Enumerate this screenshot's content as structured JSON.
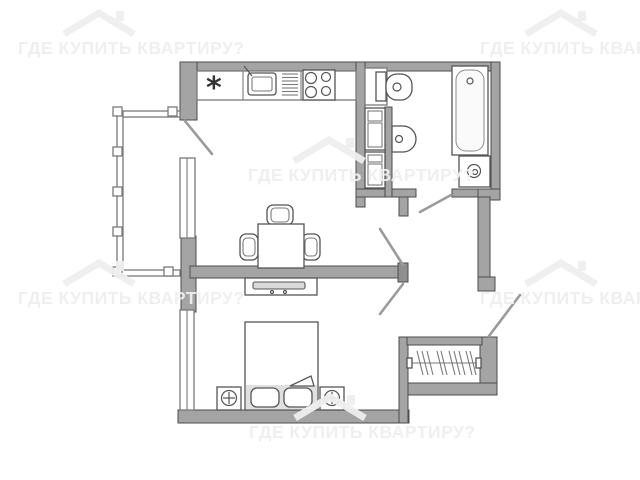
{
  "watermark": {
    "text": "ГДЕ КУПИТЬ КВАРТИРУ?",
    "color": "#eeeeee",
    "instances": [
      {
        "x": 18,
        "y": 39
      },
      {
        "x": 480,
        "y": 39
      },
      {
        "x": 248,
        "y": 166
      },
      {
        "x": 18,
        "y": 289
      },
      {
        "x": 480,
        "y": 289
      },
      {
        "x": 249,
        "y": 423
      }
    ]
  },
  "floorplan": {
    "canvas": {
      "w": 640,
      "h": 480
    },
    "palette": {
      "wall": "#a4a4a4",
      "wall_outline": "#4d4d4d",
      "fixture_line": "#7a7a7a",
      "shade": "#e0e0e0",
      "door_leaf": "#9b9b9b"
    },
    "kitchen_symbol": "*",
    "shapes": [
      {
        "name": "wall-top",
        "kind": "rect",
        "cls": "wall",
        "x": 183,
        "y": 62,
        "w": 317,
        "h": 9
      },
      {
        "name": "wall-left-upper",
        "kind": "rect",
        "cls": "wall",
        "x": 180,
        "y": 62,
        "w": 17,
        "h": 58
      },
      {
        "name": "wall-left-mid",
        "kind": "rect",
        "cls": "wall",
        "x": 181,
        "y": 236,
        "w": 15,
        "h": 76
      },
      {
        "name": "wall-bottom-bedroom",
        "kind": "rect",
        "cls": "wall",
        "x": 178,
        "y": 410,
        "w": 231,
        "h": 13
      },
      {
        "name": "wall-middle",
        "kind": "rect",
        "cls": "wall",
        "x": 190,
        "y": 266,
        "w": 210,
        "h": 12
      },
      {
        "name": "wall-middle-endcap",
        "kind": "rect",
        "cls": "walld",
        "x": 398,
        "y": 263,
        "w": 10,
        "h": 19
      },
      {
        "name": "wall-living-right",
        "kind": "rect",
        "cls": "wall",
        "x": 356,
        "y": 62,
        "w": 9,
        "h": 145
      },
      {
        "name": "wall-bath-bottom-left",
        "kind": "rect",
        "cls": "wall",
        "x": 356,
        "y": 189,
        "w": 60,
        "h": 8
      },
      {
        "name": "wall-door-stub",
        "kind": "rect",
        "cls": "wall",
        "x": 399,
        "y": 197,
        "w": 9,
        "h": 19
      },
      {
        "name": "wall-bath-bottom-right",
        "kind": "rect",
        "cls": "wall",
        "x": 452,
        "y": 189,
        "w": 48,
        "h": 8
      },
      {
        "name": "wall-right-top",
        "kind": "rect",
        "cls": "wall",
        "x": 491,
        "y": 62,
        "w": 9,
        "h": 135
      },
      {
        "name": "wall-right-corner",
        "kind": "rect",
        "cls": "wall",
        "x": 478,
        "y": 189,
        "w": 22,
        "h": 11
      },
      {
        "name": "wall-hall-right",
        "kind": "rect",
        "cls": "wall",
        "x": 478,
        "y": 197,
        "w": 12,
        "h": 80
      },
      {
        "name": "wall-entrance-jamb",
        "kind": "rect",
        "cls": "wall",
        "x": 478,
        "y": 277,
        "w": 17,
        "h": 14
      },
      {
        "name": "wall-wardrobe-right",
        "kind": "rect",
        "cls": "wall",
        "x": 480,
        "y": 337,
        "w": 17,
        "h": 58
      },
      {
        "name": "wall-wardrobe-bottom",
        "kind": "rect",
        "cls": "wall",
        "x": 399,
        "y": 383,
        "w": 98,
        "h": 12
      },
      {
        "name": "wall-bedroom-right",
        "kind": "rect",
        "cls": "wall",
        "x": 399,
        "y": 337,
        "w": 9,
        "h": 86
      },
      {
        "name": "wall-wardrobe-top",
        "kind": "rect",
        "cls": "wall",
        "x": 407,
        "y": 337,
        "w": 75,
        "h": 8
      },
      {
        "name": "wall-bath-inner-stub",
        "kind": "rect",
        "cls": "wall",
        "x": 385,
        "y": 107,
        "w": 7,
        "h": 90
      },
      {
        "name": "window-kitchen",
        "kind": "rect",
        "cls": "fix",
        "x": 180,
        "y": 158,
        "w": 15,
        "h": 80
      },
      {
        "name": "window-kitchen-mullion",
        "kind": "line",
        "cls": "thin",
        "x1": 187,
        "y1": 158,
        "x2": 187,
        "y2": 238
      },
      {
        "name": "window-bedroom",
        "kind": "rect",
        "cls": "fix",
        "x": 180,
        "y": 310,
        "w": 14,
        "h": 100
      },
      {
        "name": "window-bedroom-mullion",
        "kind": "line",
        "cls": "thin",
        "x1": 187,
        "y1": 310,
        "x2": 187,
        "y2": 410
      },
      {
        "name": "balcony-rail-top",
        "kind": "rect",
        "cls": "fix",
        "x": 117,
        "y": 111,
        "w": 63,
        "h": 6
      },
      {
        "name": "balcony-rail-left",
        "kind": "rect",
        "cls": "fix",
        "x": 117,
        "y": 111,
        "w": 6,
        "h": 165
      },
      {
        "name": "balcony-rail-bottom",
        "kind": "rect",
        "cls": "fix",
        "x": 117,
        "y": 270,
        "w": 63,
        "h": 6
      },
      {
        "name": "balcony-post",
        "kind": "rect",
        "cls": "fix",
        "x": 113,
        "y": 107,
        "w": 9,
        "h": 9
      },
      {
        "name": "balcony-post",
        "kind": "rect",
        "cls": "fix",
        "x": 113,
        "y": 147,
        "w": 9,
        "h": 9
      },
      {
        "name": "balcony-post",
        "kind": "rect",
        "cls": "fix",
        "x": 113,
        "y": 187,
        "w": 9,
        "h": 9
      },
      {
        "name": "balcony-post",
        "kind": "rect",
        "cls": "fix",
        "x": 113,
        "y": 227,
        "w": 9,
        "h": 9
      },
      {
        "name": "balcony-post",
        "kind": "rect",
        "cls": "fix",
        "x": 113,
        "y": 267,
        "w": 9,
        "h": 9
      },
      {
        "name": "balcony-post",
        "kind": "rect",
        "cls": "fix",
        "x": 168,
        "y": 107,
        "w": 9,
        "h": 9
      },
      {
        "name": "balcony-post",
        "kind": "rect",
        "cls": "fix",
        "x": 164,
        "y": 267,
        "w": 9,
        "h": 9
      },
      {
        "name": "kitchen-counter",
        "kind": "rect",
        "cls": "fix",
        "x": 197,
        "y": 71,
        "w": 159,
        "h": 29
      },
      {
        "name": "counter-divider",
        "kind": "line",
        "cls": "thin",
        "x1": 243,
        "y1": 71,
        "x2": 243,
        "y2": 100
      },
      {
        "name": "counter-divider",
        "kind": "line",
        "cls": "thin",
        "x1": 301,
        "y1": 71,
        "x2": 301,
        "y2": 100
      },
      {
        "name": "fridge-symbol",
        "kind": "text",
        "cls": "glyph",
        "x": 206,
        "y": 98,
        "str": "*"
      },
      {
        "name": "kitchen-sink",
        "kind": "rect",
        "cls": "fixd",
        "x": 248,
        "y": 73,
        "w": 28,
        "h": 22,
        "rx": 3
      },
      {
        "name": "kitchen-sink-basin",
        "kind": "rect",
        "cls": "thin",
        "x": 252,
        "y": 77,
        "w": 20,
        "h": 14,
        "rx": 2
      },
      {
        "name": "kitchen-faucet",
        "kind": "line",
        "cls": "thind",
        "x1": 252,
        "y1": 76,
        "x2": 244,
        "y2": 66
      },
      {
        "name": "drying-rack-bar",
        "kind": "line",
        "cls": "thin",
        "x1": 282,
        "y1": 74,
        "x2": 298,
        "y2": 74
      },
      {
        "name": "drying-rack-bar",
        "kind": "line",
        "cls": "thin",
        "x1": 282,
        "y1": 77.5,
        "x2": 298,
        "y2": 77.5
      },
      {
        "name": "drying-rack-bar",
        "kind": "line",
        "cls": "thin",
        "x1": 282,
        "y1": 81,
        "x2": 298,
        "y2": 81
      },
      {
        "name": "drying-rack-bar",
        "kind": "line",
        "cls": "thin",
        "x1": 282,
        "y1": 84.5,
        "x2": 298,
        "y2": 84.5
      },
      {
        "name": "drying-rack-bar",
        "kind": "line",
        "cls": "thin",
        "x1": 282,
        "y1": 88,
        "x2": 298,
        "y2": 88
      },
      {
        "name": "drying-rack-bar",
        "kind": "line",
        "cls": "thin",
        "x1": 282,
        "y1": 91.5,
        "x2": 298,
        "y2": 91.5
      },
      {
        "name": "drying-rack-bar",
        "kind": "line",
        "cls": "thin",
        "x1": 282,
        "y1": 95,
        "x2": 298,
        "y2": 95
      },
      {
        "name": "stove",
        "kind": "rect",
        "cls": "fixd",
        "x": 303,
        "y": 70,
        "w": 32,
        "h": 30
      },
      {
        "name": "stove-burner",
        "kind": "circle",
        "cls": "thind",
        "cx": 311,
        "cy": 78,
        "r": 5.5
      },
      {
        "name": "stove-burner",
        "kind": "circle",
        "cls": "thind",
        "cx": 326,
        "cy": 77,
        "r": 4.5
      },
      {
        "name": "stove-burner",
        "kind": "circle",
        "cls": "thind",
        "cx": 311,
        "cy": 92,
        "r": 5.5
      },
      {
        "name": "stove-burner",
        "kind": "circle",
        "cls": "thind",
        "cx": 326,
        "cy": 91,
        "r": 4.5
      },
      {
        "name": "chair-top",
        "kind": "rect",
        "cls": "fixd",
        "x": 267,
        "y": 205,
        "w": 26,
        "h": 20,
        "rx": 6
      },
      {
        "name": "chair-top-seat",
        "kind": "rect",
        "cls": "thin",
        "x": 271,
        "y": 208,
        "w": 18,
        "h": 14,
        "rx": 4
      },
      {
        "name": "chair-left",
        "kind": "rect",
        "cls": "fixd",
        "x": 240,
        "y": 234,
        "w": 18,
        "h": 26,
        "rx": 6
      },
      {
        "name": "chair-left-seat",
        "kind": "rect",
        "cls": "thin",
        "x": 243,
        "y": 238,
        "w": 12,
        "h": 18,
        "rx": 4
      },
      {
        "name": "chair-right",
        "kind": "rect",
        "cls": "fixd",
        "x": 302,
        "y": 234,
        "w": 18,
        "h": 26,
        "rx": 6
      },
      {
        "name": "chair-right-seat",
        "kind": "rect",
        "cls": "thin",
        "x": 305,
        "y": 238,
        "w": 12,
        "h": 18,
        "rx": 4
      },
      {
        "name": "dining-table",
        "kind": "rect",
        "cls": "fixd",
        "x": 258,
        "y": 224,
        "w": 46,
        "h": 44
      },
      {
        "name": "tv-stand",
        "kind": "rect",
        "cls": "fixd",
        "x": 245,
        "y": 278,
        "w": 72,
        "h": 17
      },
      {
        "name": "tv",
        "kind": "rect",
        "cls": "gray",
        "x": 253,
        "y": 282,
        "w": 52,
        "h": 7,
        "rx": 2
      },
      {
        "name": "tv-foot",
        "kind": "circle",
        "cls": "thind",
        "cx": 272,
        "cy": 292,
        "r": 1.5
      },
      {
        "name": "tv-foot",
        "kind": "circle",
        "cls": "thind",
        "cx": 285,
        "cy": 292,
        "r": 1.5
      },
      {
        "name": "bed",
        "kind": "rect",
        "cls": "fixd",
        "x": 245,
        "y": 322,
        "w": 73,
        "h": 88
      },
      {
        "name": "bed-head-shade",
        "kind": "rect",
        "cls": "shade",
        "x": 246,
        "y": 385,
        "w": 71,
        "h": 24
      },
      {
        "name": "blanket-fold",
        "kind": "path",
        "cls": "fixd",
        "d": "M290,386 L311,376 L314,386 Z"
      },
      {
        "name": "pillow",
        "kind": "rect",
        "cls": "fixd",
        "x": 251,
        "y": 388,
        "w": 28,
        "h": 19,
        "rx": 6
      },
      {
        "name": "pillow",
        "kind": "rect",
        "cls": "fixd",
        "x": 284,
        "y": 388,
        "w": 28,
        "h": 19,
        "rx": 6
      },
      {
        "name": "nightstand-left",
        "kind": "rect",
        "cls": "fixd",
        "x": 217,
        "y": 387,
        "w": 24,
        "h": 23
      },
      {
        "name": "lamp-left",
        "kind": "circle",
        "cls": "thind",
        "cx": 229,
        "cy": 398,
        "r": 7.5
      },
      {
        "name": "lamp-left-cross",
        "kind": "line",
        "cls": "thind",
        "x1": 223,
        "y1": 398,
        "x2": 235,
        "y2": 398
      },
      {
        "name": "lamp-left-cross",
        "kind": "line",
        "cls": "thind",
        "x1": 229,
        "y1": 392,
        "x2": 229,
        "y2": 404
      },
      {
        "name": "nightstand-right",
        "kind": "rect",
        "cls": "fixd",
        "x": 320,
        "y": 387,
        "w": 24,
        "h": 23
      },
      {
        "name": "lamp-right",
        "kind": "circle",
        "cls": "thind",
        "cx": 332,
        "cy": 398,
        "r": 7.5
      },
      {
        "name": "lamp-right-cross",
        "kind": "line",
        "cls": "thind",
        "x1": 326,
        "y1": 398,
        "x2": 338,
        "y2": 398
      },
      {
        "name": "lamp-right-cross",
        "kind": "line",
        "cls": "thind",
        "x1": 332,
        "y1": 392,
        "x2": 332,
        "y2": 404
      },
      {
        "name": "toilet-cistern-box",
        "kind": "rect",
        "cls": "fix",
        "x": 365,
        "y": 68,
        "w": 22,
        "h": 37
      },
      {
        "name": "toilet-tank",
        "kind": "rect",
        "cls": "fixd",
        "x": 376,
        "y": 72,
        "w": 10,
        "h": 29
      },
      {
        "name": "toilet-bowl",
        "kind": "rect",
        "cls": "fixd",
        "x": 386,
        "y": 74,
        "w": 26,
        "h": 26,
        "rx": 11
      },
      {
        "name": "toilet-bowl-hole",
        "kind": "circle",
        "cls": "thind",
        "cx": 397,
        "cy": 87,
        "r": 4
      },
      {
        "name": "bath-cabinet-upper",
        "kind": "rect",
        "cls": "fixd",
        "x": 365,
        "y": 108,
        "w": 20,
        "h": 42
      },
      {
        "name": "bath-cabinet-upper-drawer",
        "kind": "rect",
        "cls": "thin",
        "x": 368,
        "y": 111,
        "w": 14,
        "h": 10
      },
      {
        "name": "bath-cabinet-upper-drawer",
        "kind": "rect",
        "cls": "thin",
        "x": 368,
        "y": 123,
        "w": 14,
        "h": 24
      },
      {
        "name": "bath-cabinet-lower",
        "kind": "rect",
        "cls": "fixd",
        "x": 365,
        "y": 152,
        "w": 20,
        "h": 36
      },
      {
        "name": "bath-cabinet-lower-drawer",
        "kind": "rect",
        "cls": "thin",
        "x": 368,
        "y": 155,
        "w": 14,
        "h": 7
      },
      {
        "name": "bath-cabinet-lower-drawer",
        "kind": "rect",
        "cls": "thin",
        "x": 368,
        "y": 164,
        "w": 14,
        "h": 21
      },
      {
        "name": "wall-sink",
        "kind": "path",
        "cls": "fixd",
        "d": "M392,126 h11 a13,13 0 0 1 0,26 h-11 z"
      },
      {
        "name": "wall-sink-drain",
        "kind": "circle",
        "cls": "thind",
        "cx": 399,
        "cy": 139,
        "r": 3.5
      },
      {
        "name": "bathtub",
        "kind": "rect",
        "cls": "fixd",
        "x": 452,
        "y": 66,
        "w": 36,
        "h": 89
      },
      {
        "name": "bathtub-basin",
        "kind": "rect",
        "cls": "inner",
        "x": 456,
        "y": 70,
        "w": 28,
        "h": 81,
        "rx": 10
      },
      {
        "name": "bathtub-drain",
        "kind": "circle",
        "cls": "thind",
        "cx": 470,
        "cy": 81,
        "r": 3
      },
      {
        "name": "washing-machine",
        "kind": "rect",
        "cls": "fixd",
        "x": 459,
        "y": 156,
        "w": 31,
        "h": 31
      },
      {
        "name": "washing-machine-door",
        "kind": "circle",
        "cls": "thind",
        "cx": 474,
        "cy": 171,
        "r": 6.5
      },
      {
        "name": "washing-machine-hub",
        "kind": "circle",
        "cls": "thind",
        "cx": 475,
        "cy": 172,
        "r": 2.5
      },
      {
        "name": "wardrobe-rail",
        "kind": "line",
        "cls": "thin",
        "x1": 409,
        "y1": 363,
        "x2": 479,
        "y2": 363
      },
      {
        "name": "wardrobe-rail-cap",
        "kind": "rect",
        "cls": "fixd",
        "x": 407,
        "y": 358,
        "w": 5,
        "h": 10
      },
      {
        "name": "wardrobe-rail-cap",
        "kind": "rect",
        "cls": "fixd",
        "x": 476,
        "y": 358,
        "w": 5,
        "h": 10
      },
      {
        "name": "hanger",
        "kind": "line",
        "cls": "thin",
        "x1": 417,
        "y1": 351,
        "x2": 423,
        "y2": 375
      },
      {
        "name": "hanger",
        "kind": "line",
        "cls": "thin",
        "x1": 422,
        "y1": 351,
        "x2": 428,
        "y2": 375
      },
      {
        "name": "hanger",
        "kind": "line",
        "cls": "thin",
        "x1": 427,
        "y1": 351,
        "x2": 433,
        "y2": 375
      },
      {
        "name": "hanger",
        "kind": "line",
        "cls": "thin",
        "x1": 437,
        "y1": 351,
        "x2": 443,
        "y2": 375
      },
      {
        "name": "hanger",
        "kind": "line",
        "cls": "thin",
        "x1": 441,
        "y1": 351,
        "x2": 447,
        "y2": 375
      },
      {
        "name": "hanger",
        "kind": "line",
        "cls": "thin",
        "x1": 449,
        "y1": 351,
        "x2": 455,
        "y2": 375
      },
      {
        "name": "hanger",
        "kind": "line",
        "cls": "thin",
        "x1": 454,
        "y1": 351,
        "x2": 460,
        "y2": 375
      },
      {
        "name": "hanger",
        "kind": "line",
        "cls": "thin",
        "x1": 459,
        "y1": 351,
        "x2": 465,
        "y2": 375
      },
      {
        "name": "hanger",
        "kind": "line",
        "cls": "thin",
        "x1": 466,
        "y1": 351,
        "x2": 472,
        "y2": 375
      },
      {
        "name": "hanger",
        "kind": "line",
        "cls": "thin",
        "x1": 470,
        "y1": 351,
        "x2": 476,
        "y2": 375
      },
      {
        "name": "door-balcony",
        "kind": "line",
        "cls": "door",
        "x1": 185,
        "y1": 121,
        "x2": 212,
        "y2": 154
      },
      {
        "name": "door-living-room",
        "kind": "line",
        "cls": "door",
        "x1": 403,
        "y1": 265,
        "x2": 380,
        "y2": 229
      },
      {
        "name": "door-bedroom",
        "kind": "line",
        "cls": "door",
        "x1": 403,
        "y1": 284,
        "x2": 380,
        "y2": 314
      },
      {
        "name": "door-bathroom",
        "kind": "line",
        "cls": "door",
        "x1": 451,
        "y1": 195,
        "x2": 420,
        "y2": 212
      },
      {
        "name": "door-entrance",
        "kind": "line",
        "cls": "door",
        "x1": 489,
        "y1": 336,
        "x2": 520,
        "y2": 295
      }
    ]
  }
}
